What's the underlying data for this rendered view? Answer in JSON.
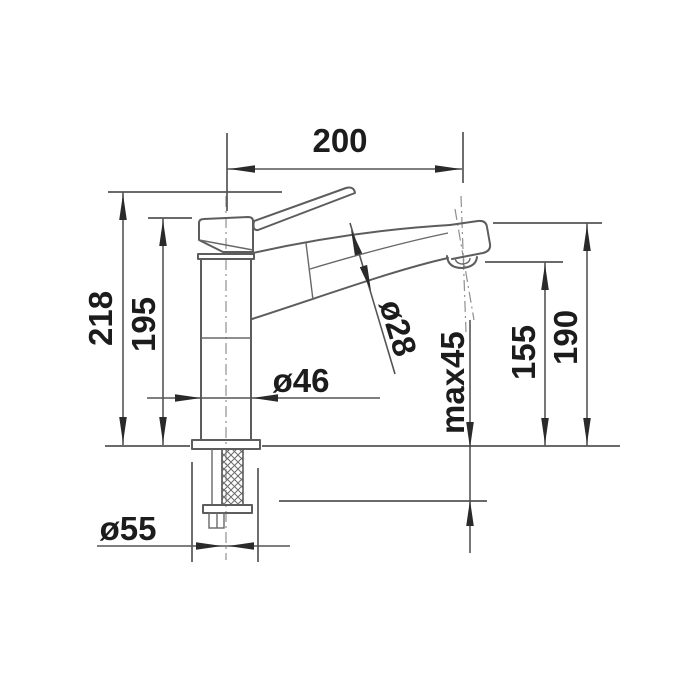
{
  "drawing": {
    "type": "faucet-dimensional-drawing",
    "unit": "mm",
    "dims": {
      "reach": "200",
      "total_height": "218",
      "body_height": "195",
      "body_diameter": "ø46",
      "spout_diameter": "ø28",
      "max_deck_thickness": "max45",
      "outlet_clearance": "155",
      "outlet_height": "190",
      "base_diameter": "ø55"
    }
  },
  "colors": {
    "background": "#ffffff",
    "line_ink": "#5d5d5d",
    "dimension_ink": "#555555",
    "text_ink": "#1c1c1c",
    "arrow_ink": "#2a2a2a",
    "centerline_ink": "#8f8f8f"
  }
}
